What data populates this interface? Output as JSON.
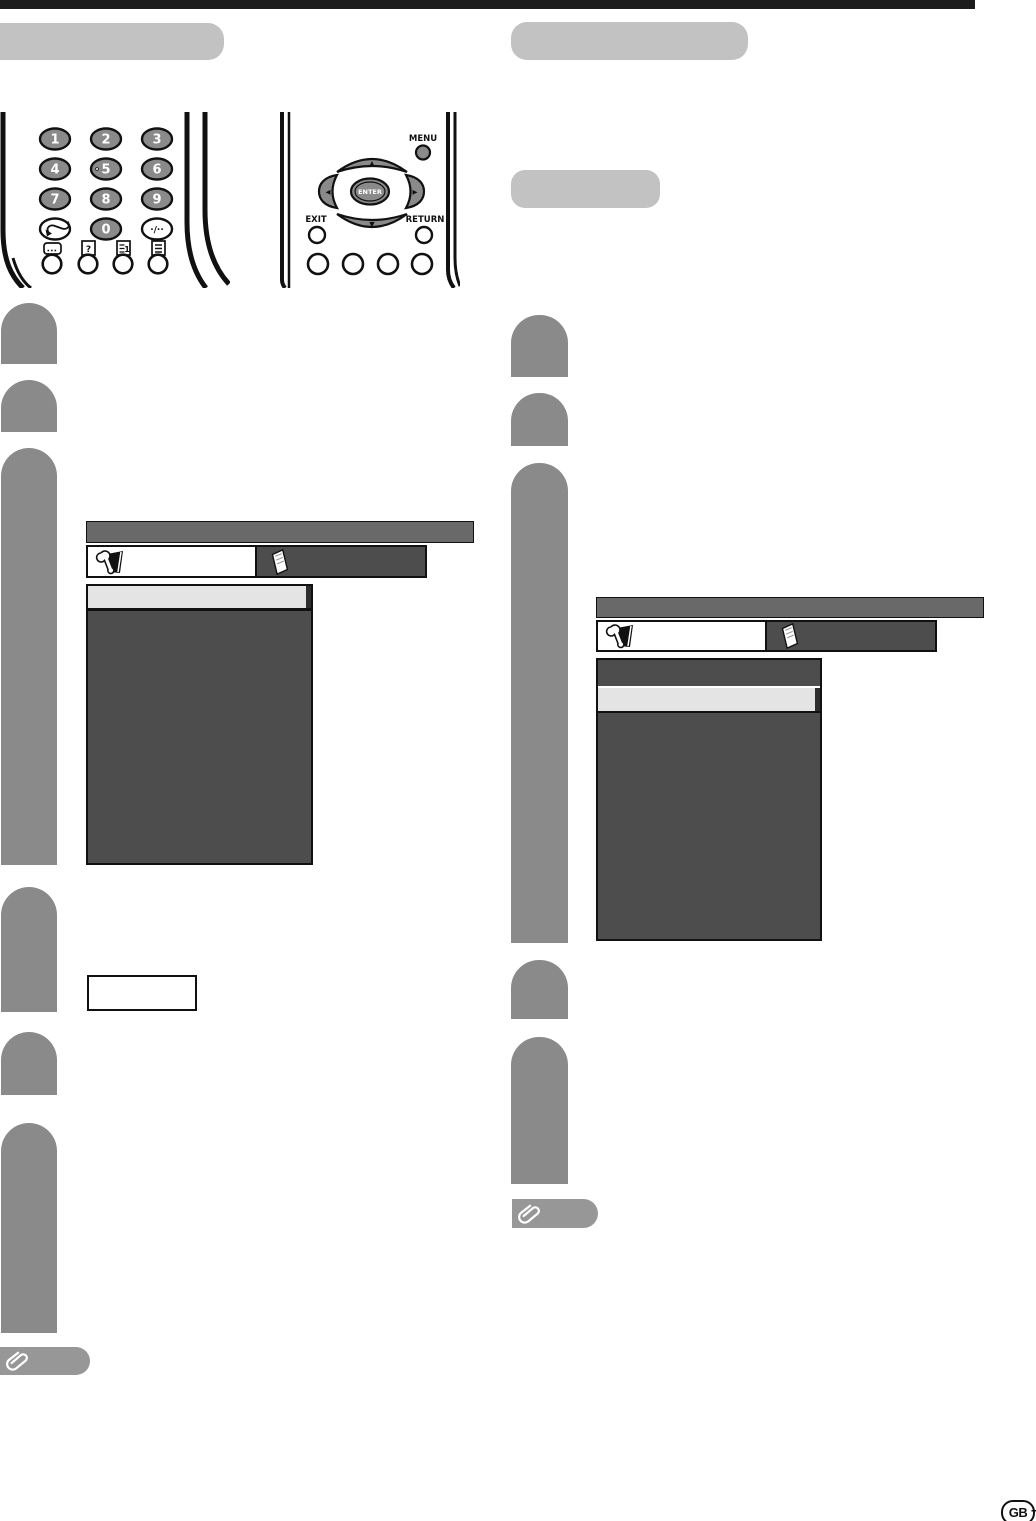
{
  "page": {
    "language_badge": "GB",
    "page_dash": "–"
  },
  "sections": {
    "left_title": "",
    "right_title": "",
    "right_subtitle": ""
  },
  "remote": {
    "number_keys": [
      "1",
      "2",
      "3",
      "4",
      "5",
      "6",
      "7",
      "8",
      "9",
      "0"
    ],
    "dot_key_label": "·/··",
    "menu_label": "MENU",
    "enter_label": "ENTER",
    "exit_label": "EXIT",
    "return_label": "RETURN"
  },
  "glyphs": {
    "up": "▲",
    "down": "▼",
    "left": "◀",
    "right": "▶"
  },
  "icons": {
    "flashback": "flashback-arrow-icon",
    "subtitle": "subtitle-icon",
    "reveal": "reveal-icon",
    "reveal_glyph": "?",
    "index": "index-page-icon",
    "index_glyph": "1",
    "teletext": "teletext-list-icon",
    "setup_tab": "wrench-icon",
    "osd_tab": "booklet-icon",
    "note": "paperclip-icon"
  },
  "colors": {
    "step_pill": "#8a8a8a",
    "section_header": "#c2c2c2",
    "menu_title_bar": "#696969",
    "menu_body": "#4d4d4d",
    "selected_row": "#e4e4e4",
    "note_tag": "#979797",
    "top_rule": "#1c1c1c"
  }
}
